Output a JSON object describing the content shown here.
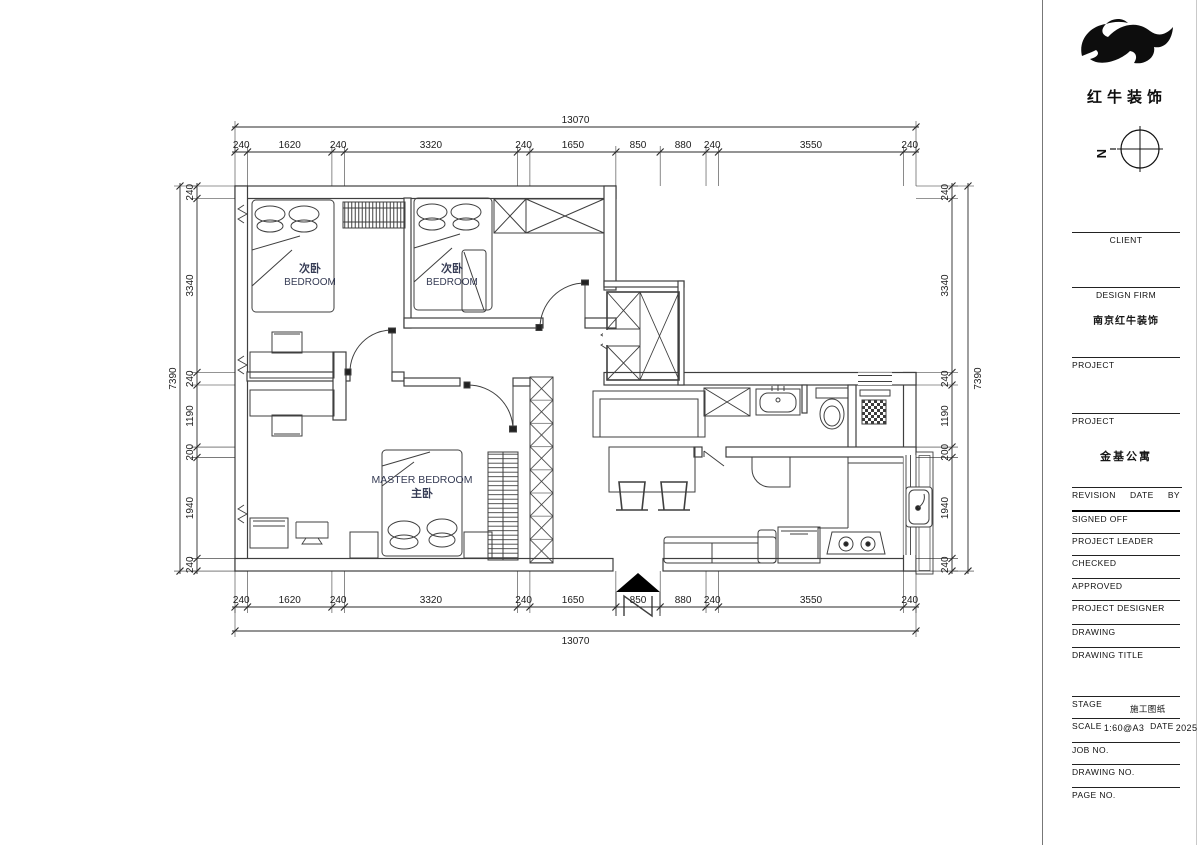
{
  "brand": {
    "name": "红牛装饰",
    "compass_label": "N"
  },
  "plan": {
    "origin_x": 235,
    "origin_y": 186,
    "px_per_mm": 0.052104,
    "overall_width_mm": "13070",
    "overall_height_mm": "7390",
    "h_segments_mm": [
      240,
      1620,
      240,
      3320,
      240,
      1650,
      850,
      880,
      240,
      3550,
      240
    ],
    "v_segments_mm": [
      240,
      3340,
      240,
      1190,
      200,
      1940,
      240
    ],
    "rooms": {
      "bedroom1": {
        "zh": "次卧",
        "en": "BEDROOM"
      },
      "bedroom2": {
        "zh": "次卧",
        "en": "BEDROOM"
      },
      "master": {
        "en": "MASTER  BEDROOM",
        "zh": "主卧"
      }
    }
  },
  "titleblock": {
    "client_label": "CLIENT",
    "design_firm_label": "DESIGN  FIRM",
    "design_firm_value": "南京红牛装饰",
    "project_label1": "PROJECT",
    "project_label2": "PROJECT",
    "project_value": "金基公寓",
    "revision_label": "REVISION",
    "date_label": "DATE",
    "by_label": "BY",
    "signed_off_label": "SIGNED  OFF",
    "project_leader_label": "PROJECT  LEADER",
    "checked_label": "CHECKED",
    "approved_label": "APPROVED",
    "project_designer_label": "PROJECT  DESIGNER",
    "drawing_label": "DRAWING",
    "drawing_title_label": "DRAWING  TITLE",
    "stage_label": "STAGE",
    "stage_value": "施工图纸",
    "scale_label": "SCALE",
    "scale_value": "1:60@A3",
    "date2_label": "DATE",
    "date_value": "2025",
    "job_no_label": "JOB  NO.",
    "drawing_no_label": "DRAWING  NO.",
    "page_no_label": "PAGE  NO."
  }
}
